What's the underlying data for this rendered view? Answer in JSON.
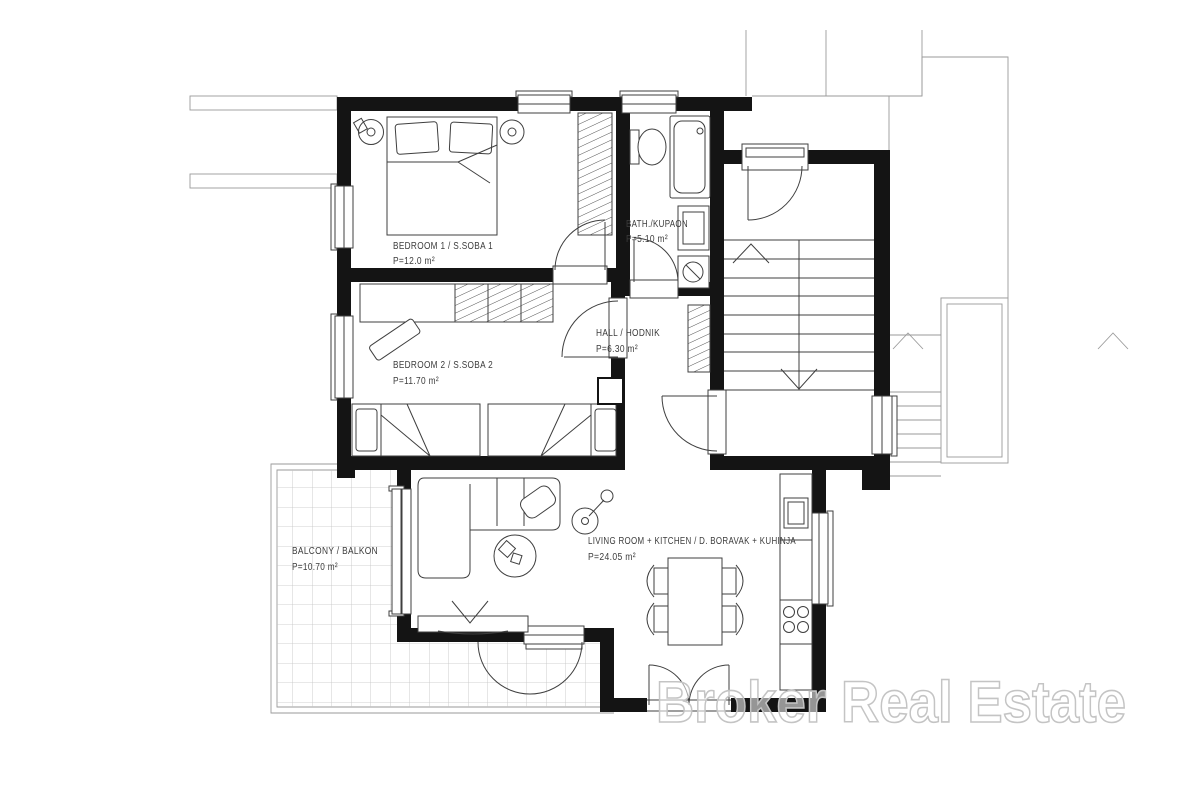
{
  "watermark": {
    "text": "Broker Real Estate"
  },
  "rooms": [
    {
      "id": "bedroom-1",
      "name": "BEDROOM 1 / S.SOBA 1",
      "area": "P=12.0 m²"
    },
    {
      "id": "bedroom-2",
      "name": "BEDROOM 2 / S.SOBA 2",
      "area": "P=11.70 m²"
    },
    {
      "id": "bath",
      "name": "BATH./KUPAON",
      "area": "P=5.10 m²"
    },
    {
      "id": "hall",
      "name": "HALL / HODNIK",
      "area": "P=6.30 m²"
    },
    {
      "id": "living",
      "name": "LIVING ROOM + KITCHEN / D. BORAVAK + KUHINJA",
      "area": "P=24.05 m²"
    },
    {
      "id": "balcony",
      "name": "BALCONY / BALKON",
      "area": "P=10.70 m²"
    }
  ],
  "colors": {
    "wall": "#141414",
    "line": "#3f3f3f",
    "faint": "#9a9a9a",
    "grid": "#c2c2c2",
    "text": "#3c3c3c",
    "watermark": "#c4c4c4"
  }
}
